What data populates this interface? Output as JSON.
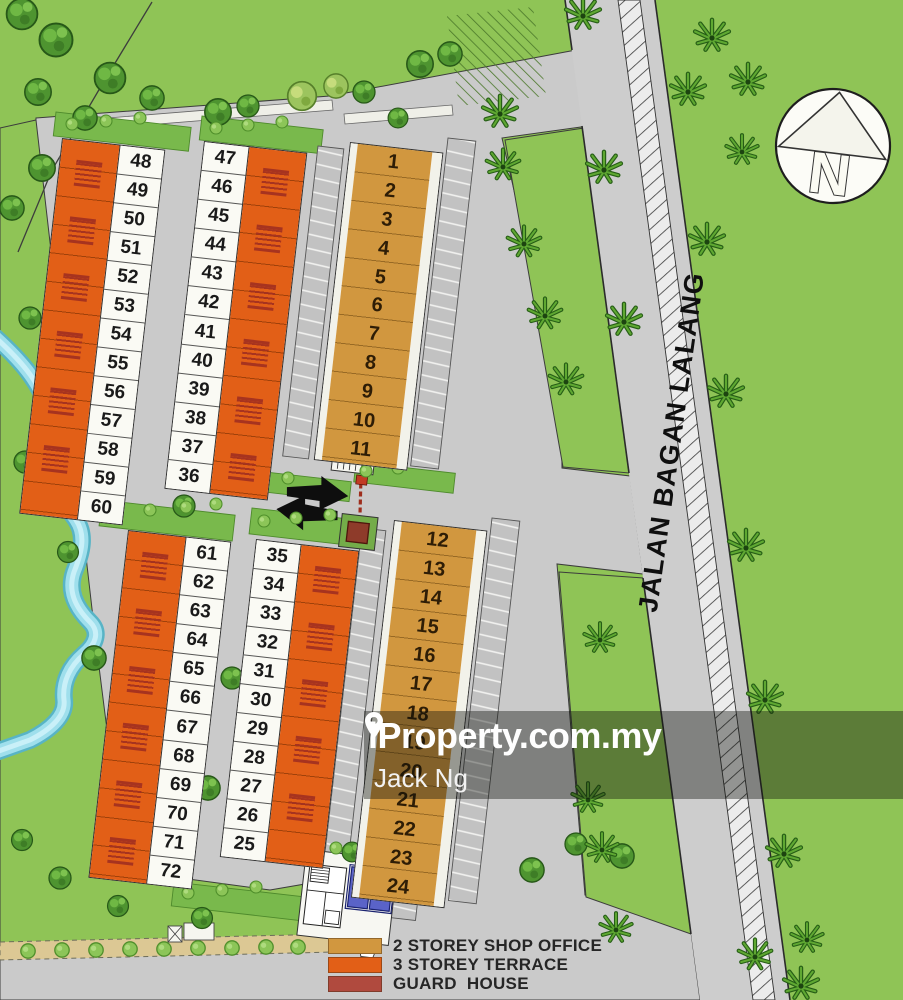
{
  "map": {
    "road_label": "JALAN BAGAN LALANG",
    "north_label": "N"
  },
  "watermark": {
    "brand": "iProperty.com.my",
    "agent": "Jack Ng",
    "pin_icon": "location-pin"
  },
  "legend": {
    "items": [
      {
        "key": "shop",
        "label": "2 STOREY SHOP OFFICE",
        "color": "#D1973F"
      },
      {
        "key": "terrace",
        "label": "3 STOREY TERRACE",
        "color": "#E25F17"
      },
      {
        "key": "guard",
        "label": "GUARD  HOUSE",
        "color": "#B04A3E"
      }
    ]
  },
  "blocks": [
    {
      "id": "t1",
      "type": "3-storey-terrace",
      "lots": [
        "48",
        "49",
        "50",
        "51",
        "52",
        "53",
        "54",
        "55",
        "56",
        "57",
        "58",
        "59",
        "60"
      ]
    },
    {
      "id": "t2",
      "type": "3-storey-terrace",
      "lots": [
        "47",
        "46",
        "45",
        "44",
        "43",
        "42",
        "41",
        "40",
        "39",
        "38",
        "37",
        "36"
      ]
    },
    {
      "id": "s1",
      "type": "2-storey-shop-office",
      "lots": [
        "1",
        "2",
        "3",
        "4",
        "5",
        "6",
        "7",
        "8",
        "9",
        "10",
        "11"
      ]
    },
    {
      "id": "t3",
      "type": "3-storey-terrace",
      "lots": [
        "61",
        "62",
        "63",
        "64",
        "65",
        "66",
        "67",
        "68",
        "69",
        "70",
        "71",
        "72"
      ]
    },
    {
      "id": "t4",
      "type": "3-storey-terrace",
      "lots": [
        "35",
        "34",
        "33",
        "32",
        "31",
        "30",
        "29",
        "28",
        "27",
        "26",
        "25"
      ]
    },
    {
      "id": "s2",
      "type": "2-storey-shop-office",
      "lots": [
        "12",
        "13",
        "14",
        "15",
        "16",
        "17",
        "18",
        "19",
        "20",
        "21",
        "22",
        "23",
        "24"
      ]
    }
  ],
  "colors": {
    "grass": "#8FC456",
    "road": "#CACACA",
    "water": "#9FDFEC",
    "terrace": "#E25F17",
    "shop": "#D1973F",
    "guard": "#B04A3E"
  }
}
